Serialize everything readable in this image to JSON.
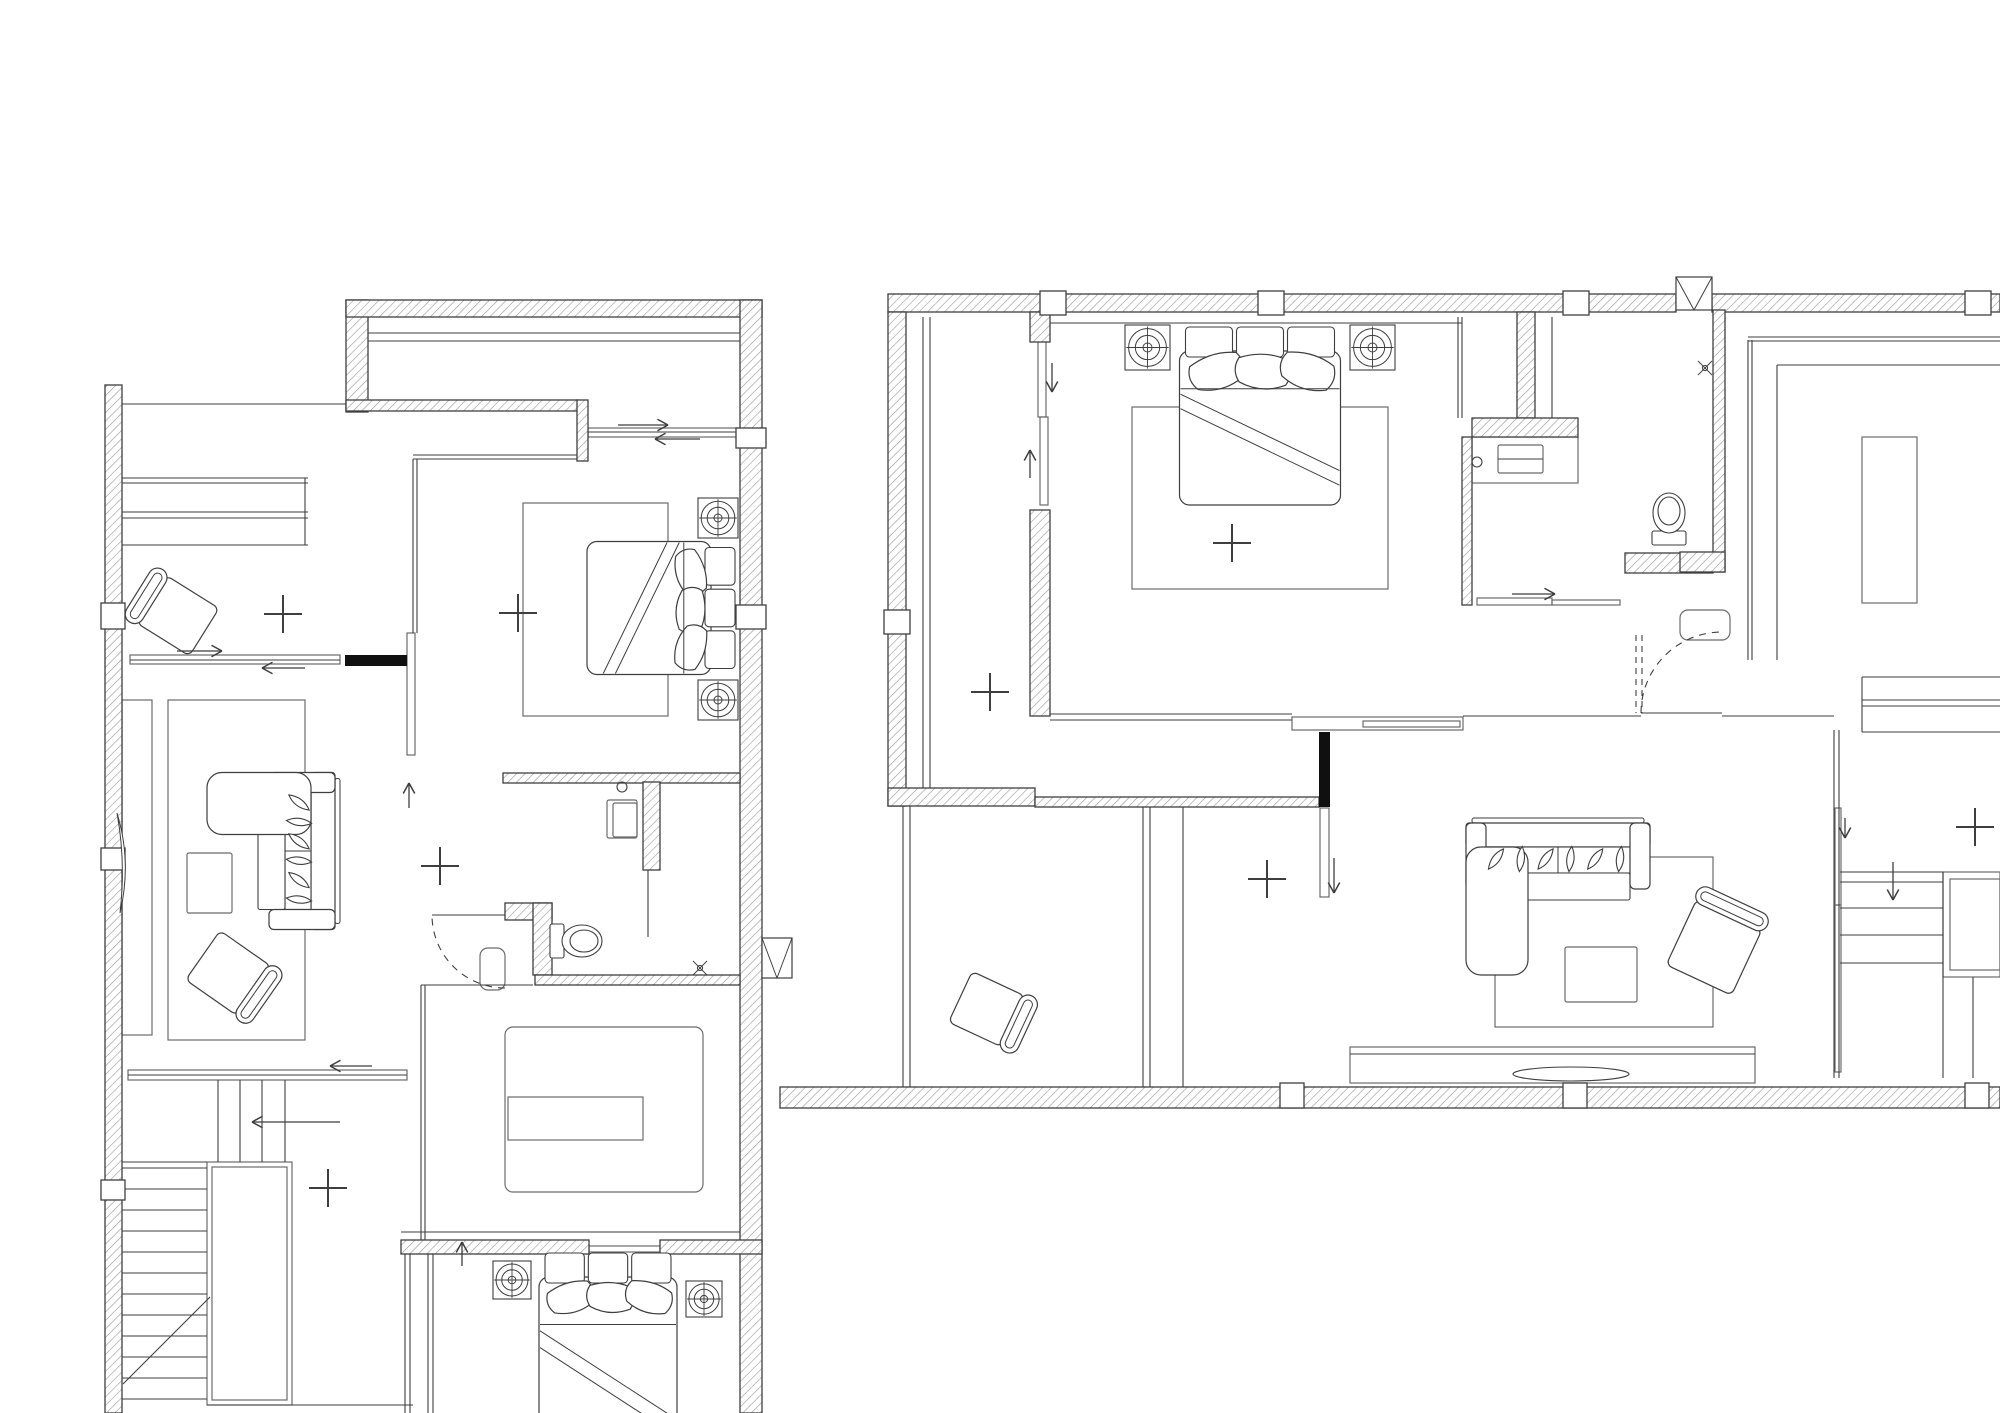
{
  "canvas": {
    "width": 2000,
    "height": 1413,
    "background": "#ffffff",
    "ink": "#3e3e3e",
    "thin": "#565656",
    "hatch_line": "#979797",
    "rug": "#6b6b6b",
    "solid": "#101010"
  },
  "plans": [
    {
      "id": "left-floor-plan",
      "hatched_walls": [
        [
          105,
          385,
          17,
          1028
        ],
        [
          346,
          300,
          22,
          112
        ],
        [
          346,
          300,
          416,
          17
        ],
        [
          740,
          300,
          22,
          1113
        ],
        [
          346,
          400,
          232,
          11
        ],
        [
          577,
          400,
          11,
          61
        ],
        [
          503,
          773,
          237,
          10
        ],
        [
          643,
          782,
          17,
          88
        ],
        [
          505,
          903,
          47,
          17
        ],
        [
          533,
          903,
          19,
          72
        ],
        [
          535,
          975,
          205,
          10
        ],
        [
          401,
          1240,
          188,
          14
        ],
        [
          660,
          1240,
          102,
          14
        ]
      ],
      "columns": [
        [
          101,
          603,
          24,
          26
        ],
        [
          101,
          848,
          24,
          22
        ],
        [
          101,
          1180,
          24,
          20
        ],
        [
          736,
          428,
          30,
          20
        ],
        [
          736,
          605,
          30,
          24
        ]
      ],
      "solid_walls": [
        [
          345,
          655,
          62,
          11
        ]
      ],
      "x_boxes": [
        [
          762,
          938,
          30,
          40
        ]
      ],
      "lines": [
        [
          122,
          404,
          346,
          404
        ],
        [
          122,
          545,
          308,
          545
        ],
        [
          305,
          478,
          305,
          545
        ],
        [
          648,
          870,
          648,
          937
        ],
        [
          130,
          660,
          340,
          660
        ],
        [
          128,
          1075,
          407,
          1075
        ],
        [
          588,
          432,
          737,
          432
        ],
        [
          432,
          915,
          505,
          915
        ],
        [
          122,
          1168,
          207,
          1168
        ],
        [
          122,
          1189,
          207,
          1189
        ],
        [
          122,
          1210,
          207,
          1210
        ],
        [
          122,
          1231,
          207,
          1231
        ],
        [
          122,
          1252,
          207,
          1252
        ],
        [
          122,
          1273,
          207,
          1273
        ],
        [
          122,
          1294,
          207,
          1294
        ],
        [
          122,
          1315,
          207,
          1315
        ],
        [
          122,
          1336,
          207,
          1336
        ],
        [
          122,
          1357,
          207,
          1357
        ],
        [
          122,
          1378,
          207,
          1378
        ],
        [
          122,
          1399,
          207,
          1399
        ],
        [
          210,
          1297,
          123,
          1384
        ],
        [
          207,
          1405,
          413,
          1405
        ],
        [
          218,
          1080,
          218,
          1162
        ],
        [
          240,
          1080,
          240,
          1162
        ],
        [
          262,
          1080,
          262,
          1162
        ],
        [
          285,
          1080,
          285,
          1162
        ],
        [
          122,
          1162,
          207,
          1162
        ],
        [
          405,
          1254,
          405,
          1413
        ],
        [
          410,
          1254,
          410,
          1413
        ],
        [
          428,
          1254,
          428,
          1413
        ],
        [
          433,
          1254,
          433,
          1413
        ],
        [
          401,
          1232,
          740,
          1232
        ],
        [
          421,
          985,
          533,
          985
        ]
      ],
      "double_lines": [
        [
          368,
          333,
          740,
          333,
          8
        ],
        [
          122,
          478,
          308,
          478,
          5
        ],
        [
          122,
          512,
          308,
          512,
          6
        ],
        [
          413,
          455,
          577,
          455,
          4
        ],
        [
          413,
          459,
          413,
          633,
          4
        ],
        [
          421,
          985,
          421,
          1240,
          4
        ]
      ],
      "dashed_lines": [],
      "dashed_arcs": [
        [
          505,
          915,
          73,
          90,
          180
        ]
      ],
      "rects": [
        [
          122,
          700,
          30,
          335,
          0
        ],
        [
          168,
          700,
          137,
          340,
          0
        ],
        [
          187,
          853,
          45,
          60,
          2
        ],
        [
          523,
          503,
          145,
          213,
          0
        ],
        [
          508,
          1097,
          135,
          43,
          0
        ],
        [
          505,
          1027,
          198,
          165,
          8
        ],
        [
          588,
          428,
          149,
          9,
          0
        ],
        [
          130,
          655,
          210,
          9,
          0
        ],
        [
          128,
          1070,
          279,
          10,
          0
        ],
        [
          407,
          633,
          8,
          122,
          0
        ],
        [
          607,
          800,
          30,
          38,
          2
        ],
        [
          613,
          803,
          24,
          34,
          2
        ],
        [
          480,
          948,
          25,
          42,
          8
        ],
        [
          589,
          1246,
          71,
          6,
          0
        ],
        [
          207,
          1162,
          85,
          243,
          0
        ],
        [
          212,
          1167,
          75,
          233,
          0
        ]
      ],
      "circles": [
        [
          622,
          787,
          5
        ]
      ],
      "ellipses": [],
      "paths": [
        "M117,813 Q132,862 120,913 Q126,862 117,813 Z"
      ],
      "beds": [
        {
          "cx": 661,
          "cy": 608,
          "w": 137,
          "h": 152,
          "rot": 90
        },
        {
          "cx": 608,
          "cy": 1356,
          "w": 142,
          "h": 210,
          "rot": 0
        }
      ],
      "lamps": [
        [
          698,
          498,
          40
        ],
        [
          698,
          680,
          40
        ],
        [
          493,
          1261,
          38
        ],
        [
          686,
          1281,
          36
        ]
      ],
      "sofas": [
        {
          "cx": 271,
          "cy": 851,
          "w": 157,
          "h": 128,
          "rot": 90
        }
      ],
      "armchairs": [
        {
          "cx": 172,
          "cy": 612,
          "w": 80,
          "h": 62,
          "rot": 32
        },
        {
          "cx": 234,
          "cy": 977,
          "w": 80,
          "h": 66,
          "rot": 215
        }
      ],
      "toilets": [
        {
          "cx": 576,
          "cy": 941,
          "rot": -90
        }
      ],
      "sprinklers": [
        [
          700,
          968
        ]
      ],
      "arrows": [
        [
          618,
          425,
          668,
          425
        ],
        [
          700,
          439,
          655,
          439
        ],
        [
          177,
          651,
          222,
          651
        ],
        [
          305,
          668,
          262,
          668
        ],
        [
          409,
          808,
          409,
          783
        ],
        [
          372,
          1066,
          330,
          1066
        ],
        [
          340,
          1122,
          252,
          1122
        ],
        [
          462,
          1266,
          462,
          1242
        ]
      ],
      "plus_marks": [
        [
          283,
          614
        ],
        [
          518,
          613
        ],
        [
          440,
          866
        ],
        [
          328,
          1188
        ]
      ]
    },
    {
      "id": "right-floor-plan",
      "hatched_walls": [
        [
          888,
          294,
          788,
          18
        ],
        [
          1712,
          294,
          288,
          18
        ],
        [
          888,
          312,
          18,
          494
        ],
        [
          888,
          788,
          147,
          18
        ],
        [
          1030,
          312,
          20,
          30
        ],
        [
          1030,
          510,
          20,
          206
        ],
        [
          1035,
          797,
          284,
          10
        ],
        [
          1517,
          312,
          18,
          106
        ],
        [
          1472,
          418,
          106,
          19
        ],
        [
          1462,
          437,
          10,
          168
        ],
        [
          1625,
          553,
          88,
          20
        ],
        [
          1713,
          310,
          12,
          262
        ],
        [
          1680,
          552,
          45,
          20
        ],
        [
          780,
          1087,
          1220,
          21
        ]
      ],
      "columns": [
        [
          1040,
          291,
          26,
          24
        ],
        [
          1258,
          291,
          26,
          24
        ],
        [
          1563,
          291,
          26,
          24
        ],
        [
          1965,
          291,
          26,
          24
        ],
        [
          884,
          610,
          26,
          24
        ],
        [
          1280,
          1083,
          24,
          25
        ],
        [
          1563,
          1083,
          24,
          25
        ],
        [
          1965,
          1083,
          24,
          25
        ]
      ],
      "solid_walls": [
        [
          1319,
          732,
          11,
          75
        ]
      ],
      "x_boxes": [
        [
          1676,
          277,
          36,
          33
        ]
      ],
      "lines": [
        [
          1183,
          807,
          1183,
          1087
        ],
        [
          1050,
          323,
          1462,
          323
        ],
        [
          1050,
          714,
          1292,
          714
        ],
        [
          1050,
          720,
          1292,
          720
        ],
        [
          1463,
          716,
          1641,
          716
        ],
        [
          1722,
          716,
          1834,
          716
        ],
        [
          1777,
          365,
          2000,
          365
        ],
        [
          1777,
          365,
          1777,
          660
        ],
        [
          1862,
          677,
          2000,
          677
        ],
        [
          1862,
          700,
          2000,
          700
        ],
        [
          1862,
          706,
          2000,
          706
        ],
        [
          1862,
          732,
          2000,
          732
        ],
        [
          1862,
          677,
          1862,
          732
        ],
        [
          1840,
          872,
          1943,
          872
        ],
        [
          1840,
          882,
          1943,
          882
        ],
        [
          1840,
          908,
          1943,
          908
        ],
        [
          1840,
          935,
          1943,
          935
        ],
        [
          1840,
          963,
          1943,
          963
        ],
        [
          1943,
          872,
          1943,
          1078
        ],
        [
          1973,
          977,
          1973,
          1078
        ],
        [
          1350,
          1054,
          1755,
          1054
        ],
        [
          1641,
          713,
          1722,
          713
        ],
        [
          1552,
          317,
          1552,
          418
        ],
        [
          1498,
          459,
          1543,
          459
        ]
      ],
      "double_lines": [
        [
          923,
          317,
          923,
          788,
          7
        ],
        [
          903,
          806,
          903,
          1087,
          7
        ],
        [
          1143,
          807,
          1143,
          1087,
          7
        ],
        [
          1748,
          337,
          2000,
          337,
          4
        ],
        [
          1748,
          340,
          1748,
          660,
          4
        ],
        [
          1834,
          730,
          1834,
          1078,
          5
        ],
        [
          1458,
          317,
          1458,
          418,
          4
        ]
      ],
      "dashed_lines": [
        [
          1636,
          635,
          1636,
          713
        ],
        [
          1642,
          635,
          1642,
          713
        ]
      ],
      "dashed_arcs": [
        [
          1722,
          713,
          81,
          180,
          270
        ]
      ],
      "rects": [
        [
          1132,
          407,
          256,
          182,
          0
        ],
        [
          1472,
          437,
          106,
          46,
          0
        ],
        [
          1498,
          445,
          45,
          28,
          2
        ],
        [
          1680,
          610,
          50,
          30,
          8
        ],
        [
          1862,
          437,
          55,
          166,
          0
        ],
        [
          1495,
          857,
          218,
          170,
          0
        ],
        [
          1565,
          947,
          72,
          55,
          2
        ],
        [
          1350,
          1047,
          405,
          36,
          0
        ],
        [
          1292,
          717,
          171,
          13,
          0
        ],
        [
          1363,
          721,
          97,
          6,
          0
        ],
        [
          1943,
          872,
          57,
          105,
          0
        ],
        [
          1950,
          879,
          50,
          91,
          0
        ],
        [
          1320,
          808,
          9,
          89,
          0
        ],
        [
          1835,
          808,
          6,
          97,
          0
        ],
        [
          1835,
          905,
          6,
          167,
          0
        ],
        [
          1038,
          340,
          8,
          77,
          0
        ],
        [
          1040,
          417,
          8,
          88,
          0
        ],
        [
          1477,
          598,
          75,
          7,
          0
        ],
        [
          1552,
          600,
          68,
          5,
          0
        ]
      ],
      "circles": [
        [
          1477,
          462,
          5
        ]
      ],
      "ellipses": [
        [
          1571,
          1074,
          58,
          7
        ]
      ],
      "paths": [],
      "beds": [
        {
          "cx": 1260,
          "cy": 416,
          "w": 165,
          "h": 182,
          "rot": 0
        }
      ],
      "lamps": [
        [
          1125,
          325,
          45
        ],
        [
          1350,
          325,
          45
        ]
      ],
      "sofas": [
        {
          "cx": 1558,
          "cy": 899,
          "w": 184,
          "h": 152,
          "rot": 0
        }
      ],
      "armchairs": [
        {
          "cx": 1717,
          "cy": 941,
          "w": 90,
          "h": 78,
          "rot": 115
        },
        {
          "cx": 993,
          "cy": 1012,
          "w": 76,
          "h": 62,
          "rot": 205
        }
      ],
      "toilets": [
        {
          "cx": 1669,
          "cy": 519,
          "rot": 180
        }
      ],
      "sprinklers": [
        [
          1705,
          368
        ]
      ],
      "arrows": [
        [
          1052,
          363,
          1052,
          392
        ],
        [
          1030,
          478,
          1030,
          450
        ],
        [
          1512,
          594,
          1555,
          594
        ],
        [
          1334,
          858,
          1334,
          893
        ],
        [
          1845,
          818,
          1845,
          838
        ],
        [
          1893,
          862,
          1893,
          900
        ]
      ],
      "plus_marks": [
        [
          1232,
          543
        ],
        [
          990,
          692
        ],
        [
          1267,
          879
        ],
        [
          1975,
          827
        ]
      ]
    }
  ]
}
